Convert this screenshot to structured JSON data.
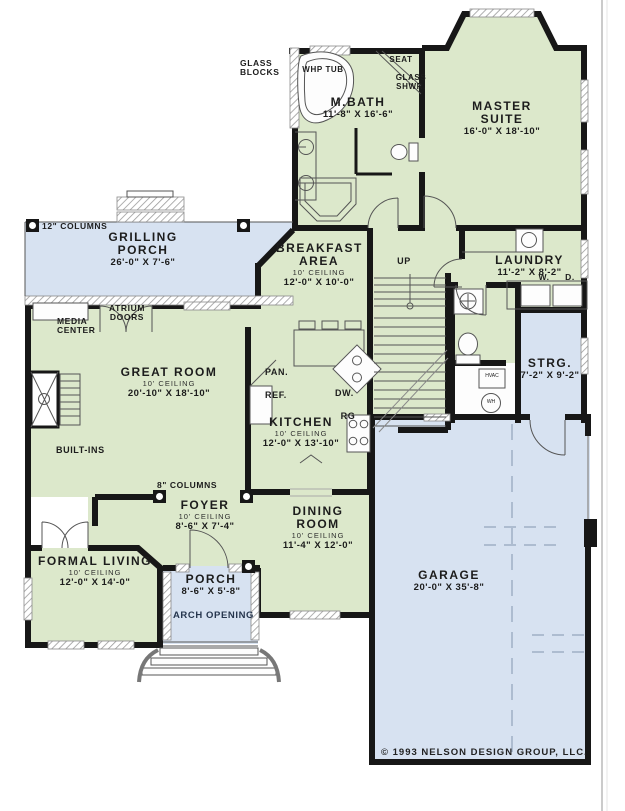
{
  "plan": {
    "title": "First floor plan",
    "copyright": "© 1993 NELSON DESIGN GROUP, LLC.",
    "colors": {
      "room_green": "#dce8cb",
      "porch_blue": "#d7e2f1",
      "wall": "#171717"
    },
    "rooms": {
      "grilling_porch": {
        "name": "GRILLING PORCH",
        "dims": "26'-0\" X 7'-6\""
      },
      "master_suite": {
        "name": "MASTER SUITE",
        "dims": "16'-0\" X 18'-10\""
      },
      "m_bath": {
        "name": "M.BATH",
        "dims": "11'-8\" X 16'-6\""
      },
      "breakfast": {
        "name": "BREAKFAST AREA",
        "ceiling": "10' CEILING",
        "dims": "12'-0\" X 10'-0\""
      },
      "laundry": {
        "name": "LAUNDRY",
        "dims": "11'-2\" X 8'-2\""
      },
      "storage": {
        "name": "STRG.",
        "dims": "7'-2\" X 9'-2\""
      },
      "great_room": {
        "name": "GREAT ROOM",
        "ceiling": "10' CEILING",
        "dims": "20'-10\" X 18'-10\""
      },
      "kitchen": {
        "name": "KITCHEN",
        "ceiling": "10' CEILING",
        "dims": "12'-0\" X 13'-10\""
      },
      "foyer": {
        "name": "FOYER",
        "ceiling": "10' CEILING",
        "dims": "8'-6\" X 7'-4\""
      },
      "dining": {
        "name": "DINING ROOM",
        "ceiling": "10' CEILING",
        "dims": "11'-4\" X 12'-0\""
      },
      "formal_living": {
        "name": "FORMAL LIVING",
        "ceiling": "10' CEILING",
        "dims": "12'-0\" X 14'-0\""
      },
      "porch": {
        "name": "PORCH",
        "dims": "8'-6\" X 5'-8\""
      },
      "garage": {
        "name": "GARAGE",
        "dims": "20'-0\" X 35'-8\""
      }
    },
    "annotations": {
      "glass_blocks": "GLASS BLOCKS",
      "whp_tub": "WHP TUB",
      "seat": "SEAT",
      "glass_shwr": "GLASS SHWR.",
      "columns_12": "12\" COLUMNS",
      "atrium_doors": "ATRIUM DOORS",
      "media_center": "MEDIA CENTER",
      "built_ins": "BUILT-INS",
      "up": "UP",
      "washer": "W.",
      "dryer": "D.",
      "pan": "PAN.",
      "ref": "REF.",
      "dw": "DW.",
      "rg": "RG",
      "columns_8": "8\" COLUMNS",
      "arch_opening": "ARCH OPENING",
      "hvac": "HVAC",
      "wh": "WH"
    }
  }
}
